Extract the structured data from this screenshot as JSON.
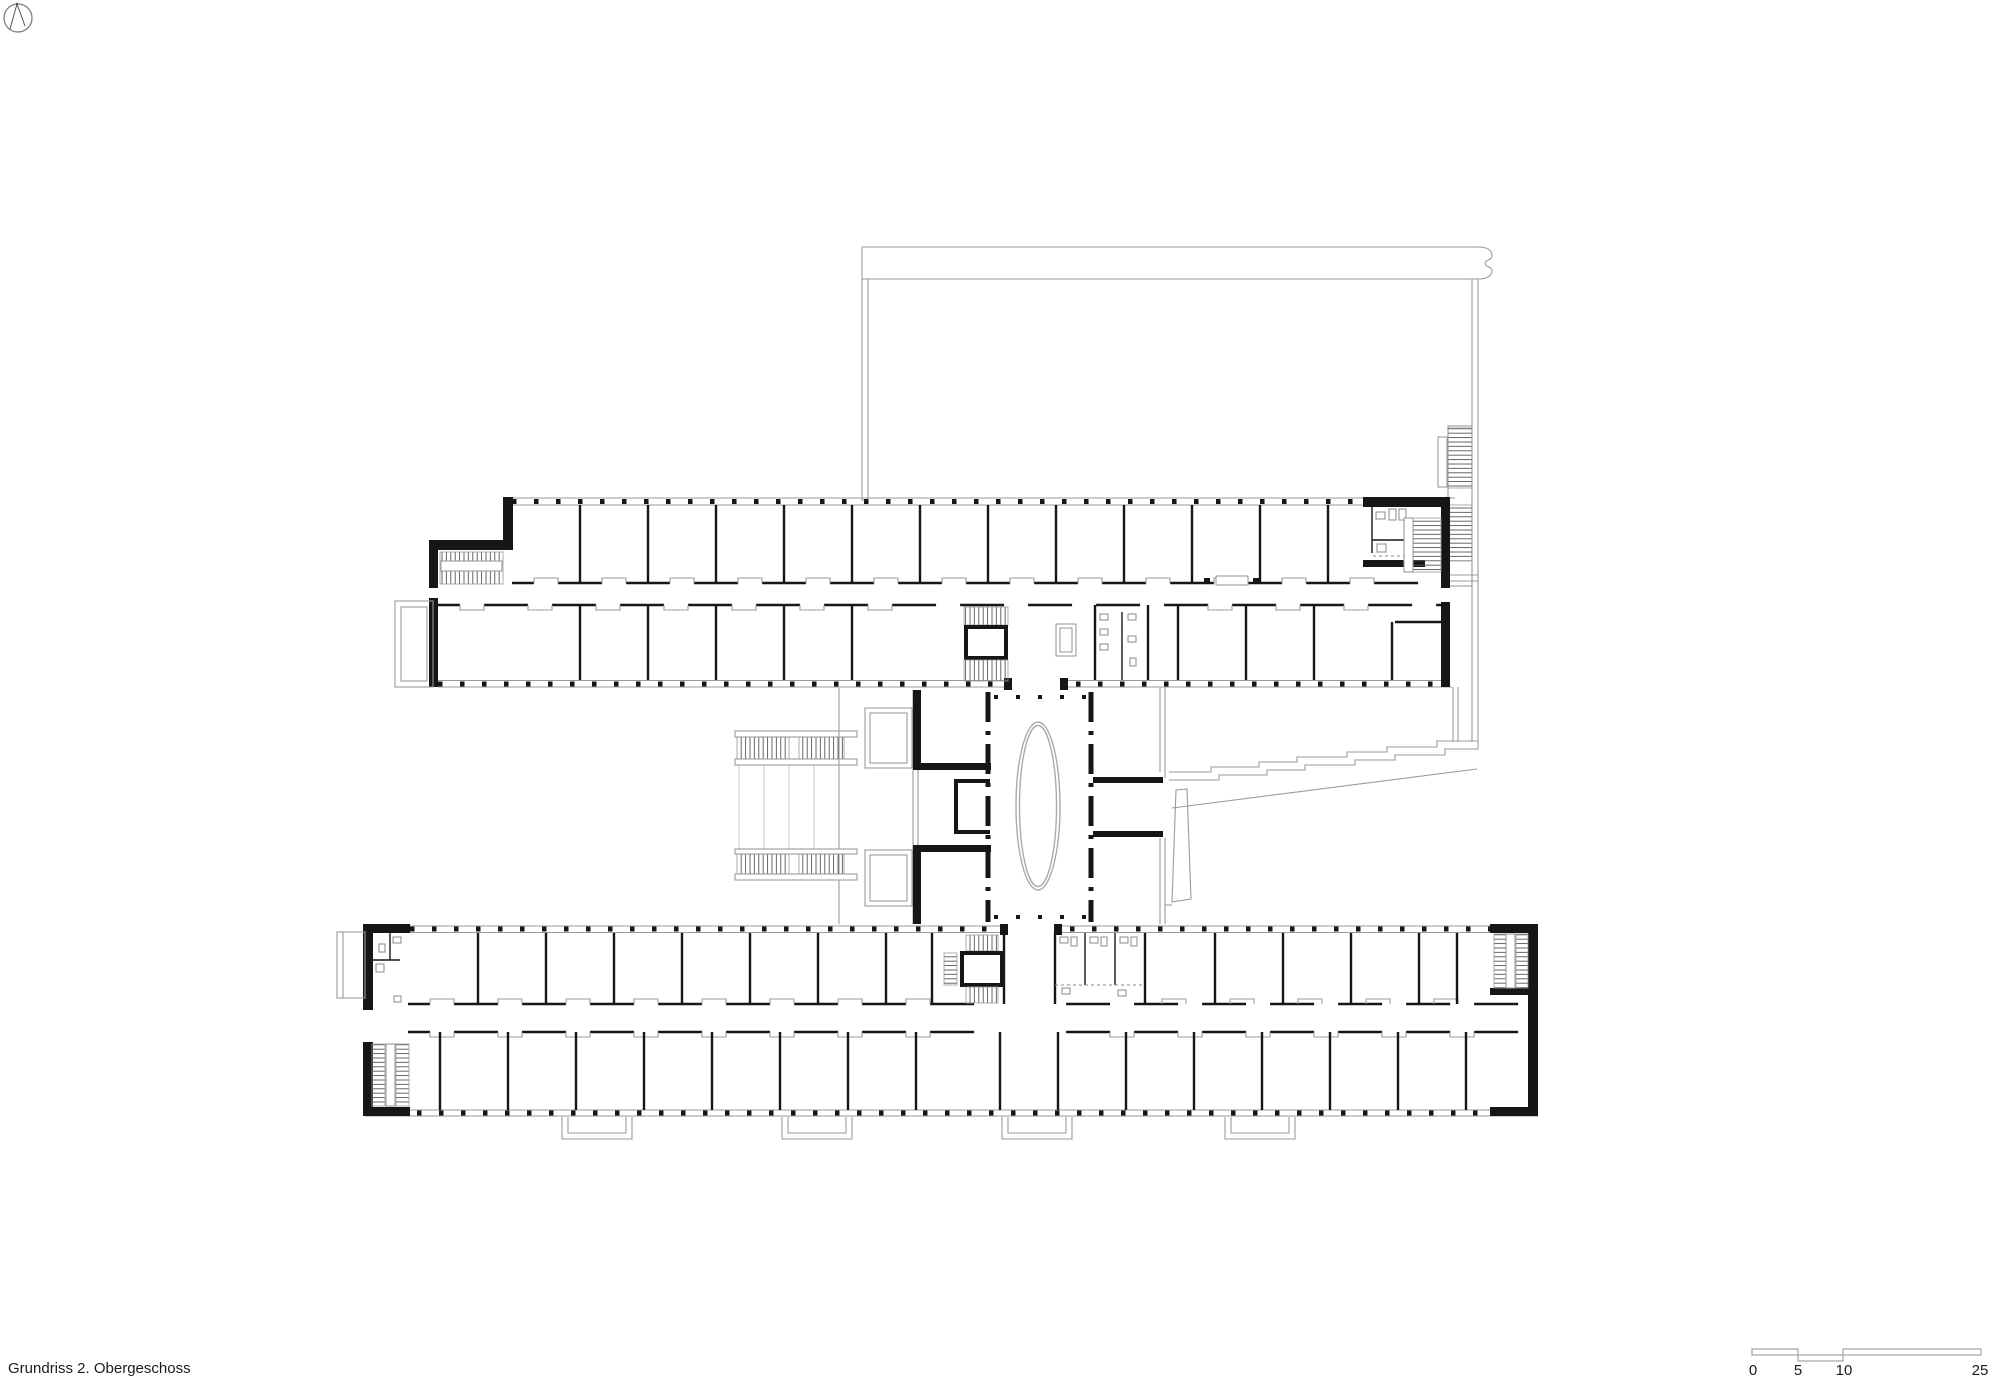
{
  "title": {
    "label": "Grundriss 2. Obergeschoss"
  },
  "scale_bar": {
    "labels": [
      "0",
      "5",
      "10",
      "25"
    ]
  },
  "north_arrow": {
    "icon": "north-arrow-icon"
  },
  "colors": {
    "wall": "#161616",
    "outline": "#9b9b9b",
    "light_outline": "#c4c4c4",
    "text": "#1c1c1c",
    "background": "#ffffff"
  },
  "plan": {
    "type": "architectural-floor-plan",
    "elements": [
      "upper-wing",
      "lower-wing",
      "central-connector",
      "elevator-oval",
      "void-stairs",
      "terrace-steps",
      "courtyard-outline",
      "outdoor-stair",
      "balconies",
      "stair-cores",
      "wc-blocks"
    ]
  }
}
